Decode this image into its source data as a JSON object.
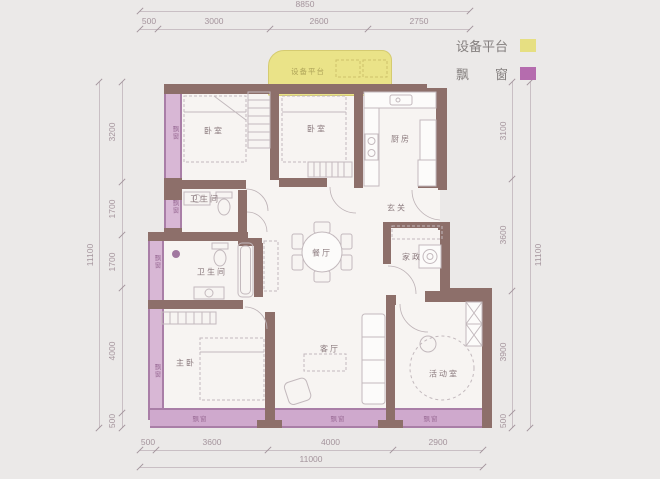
{
  "legend": {
    "items": [
      {
        "id": "equipment-platform",
        "label": "设备平台",
        "color": "#e6df82"
      },
      {
        "id": "bay-window",
        "label": "飘　　窗",
        "color": "#b56cae"
      }
    ]
  },
  "plan": {
    "platform_label": "设备平台",
    "rooms": [
      {
        "id": "bedroom-1",
        "label": "卧室",
        "x": 214,
        "y": 131
      },
      {
        "id": "bedroom-2",
        "label": "卧室",
        "x": 317,
        "y": 129
      },
      {
        "id": "kitchen",
        "label": "厨房",
        "x": 401,
        "y": 139
      },
      {
        "id": "bathroom-1",
        "label": "卫生间",
        "x": 205,
        "y": 199
      },
      {
        "id": "foyer",
        "label": "玄关",
        "x": 397,
        "y": 208
      },
      {
        "id": "bathroom-2",
        "label": "卫生间",
        "x": 212,
        "y": 272
      },
      {
        "id": "dining-room",
        "label": "餐厅",
        "x": 322,
        "y": 253
      },
      {
        "id": "laundry",
        "label": "家政",
        "x": 412,
        "y": 257
      },
      {
        "id": "master-bedroom",
        "label": "主卧",
        "x": 186,
        "y": 363
      },
      {
        "id": "living-room",
        "label": "客厅",
        "x": 330,
        "y": 349
      },
      {
        "id": "activity-room",
        "label": "活动室",
        "x": 444,
        "y": 374
      }
    ],
    "bay_window_labels": [
      {
        "label": "飘窗",
        "x": 174,
        "y": 133,
        "vertical": true
      },
      {
        "label": "飘窗",
        "x": 174,
        "y": 207,
        "vertical": true
      },
      {
        "label": "飘窗",
        "x": 156,
        "y": 262,
        "vertical": true
      },
      {
        "label": "飘窗",
        "x": 156,
        "y": 371,
        "vertical": true
      },
      {
        "label": "飘窗",
        "x": 200,
        "y": 418,
        "vertical": false
      },
      {
        "label": "飘窗",
        "x": 338,
        "y": 418,
        "vertical": false
      },
      {
        "label": "飘窗",
        "x": 431,
        "y": 418,
        "vertical": false
      }
    ]
  },
  "dimensions": {
    "top": {
      "overall": "8850",
      "segments": [
        "500",
        "3000",
        "2600",
        "2750"
      ]
    },
    "bottom": {
      "overall": "11000",
      "segments": [
        "500",
        "3600",
        "4000",
        "2900"
      ]
    },
    "left": {
      "overall": "11100",
      "segments": [
        "3200",
        "1700",
        "1700",
        "4000",
        "500"
      ]
    },
    "right": {
      "overall": "11100",
      "segments": [
        "3100",
        "3600",
        "3900",
        "500"
      ]
    }
  },
  "colors": {
    "wall": "#8d6f6a",
    "bay_fill": "#d8b7d5",
    "bay_border": "#a97ea7",
    "band_fill": "#cfa9cd",
    "platform_fill": "#eae388",
    "platform_border": "#d5cb70",
    "dim": "#a4949c",
    "room_text": "#8c7b7f"
  }
}
